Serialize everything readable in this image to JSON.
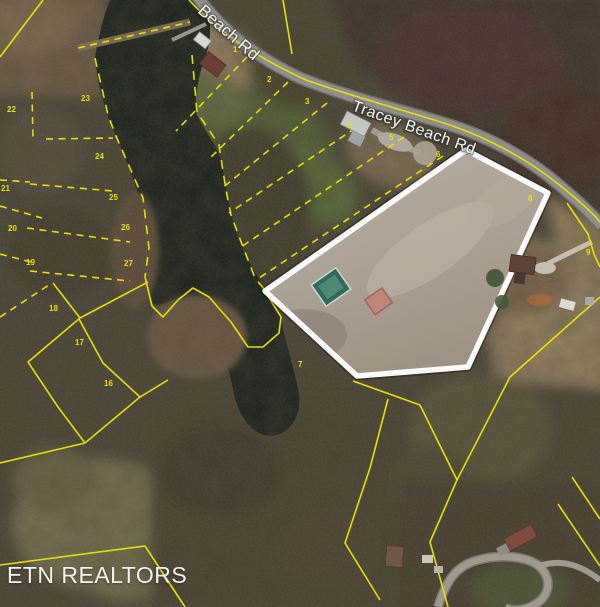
{
  "map": {
    "watermark": "ETN REALTORS",
    "road_labels": [
      {
        "text": "Beach Rd"
      },
      {
        "text": "Tracey Beach Rd"
      }
    ],
    "parcel_labels": [
      {
        "num": "1",
        "x": 233,
        "y": 52
      },
      {
        "num": "2",
        "x": 267,
        "y": 82
      },
      {
        "num": "3",
        "x": 305,
        "y": 104
      },
      {
        "num": "4",
        "x": 347,
        "y": 127
      },
      {
        "num": "5",
        "x": 389,
        "y": 140
      },
      {
        "num": "6",
        "x": 436,
        "y": 157
      },
      {
        "num": "7",
        "x": 298,
        "y": 367
      },
      {
        "num": "8",
        "x": 528,
        "y": 201
      },
      {
        "num": "9",
        "x": 586,
        "y": 255
      },
      {
        "num": "16",
        "x": 104,
        "y": 386
      },
      {
        "num": "17",
        "x": 75,
        "y": 345
      },
      {
        "num": "18",
        "x": 49,
        "y": 311
      },
      {
        "num": "19",
        "x": 26,
        "y": 265
      },
      {
        "num": "20",
        "x": 8,
        "y": 231
      },
      {
        "num": "21",
        "x": 1,
        "y": 191
      },
      {
        "num": "22",
        "x": 7,
        "y": 112
      },
      {
        "num": "23",
        "x": 81,
        "y": 101
      },
      {
        "num": "24",
        "x": 95,
        "y": 159
      },
      {
        "num": "25",
        "x": 109,
        "y": 200
      },
      {
        "num": "26",
        "x": 121,
        "y": 230
      },
      {
        "num": "27",
        "x": 124,
        "y": 266
      }
    ],
    "colors": {
      "parcel_line": "#e6e000",
      "highlight_outline": "#ffffff",
      "road": "#8f8e8a",
      "water": "#161e18",
      "label_text": "#ffffff",
      "watermark_text": "#f2f2ef"
    }
  }
}
